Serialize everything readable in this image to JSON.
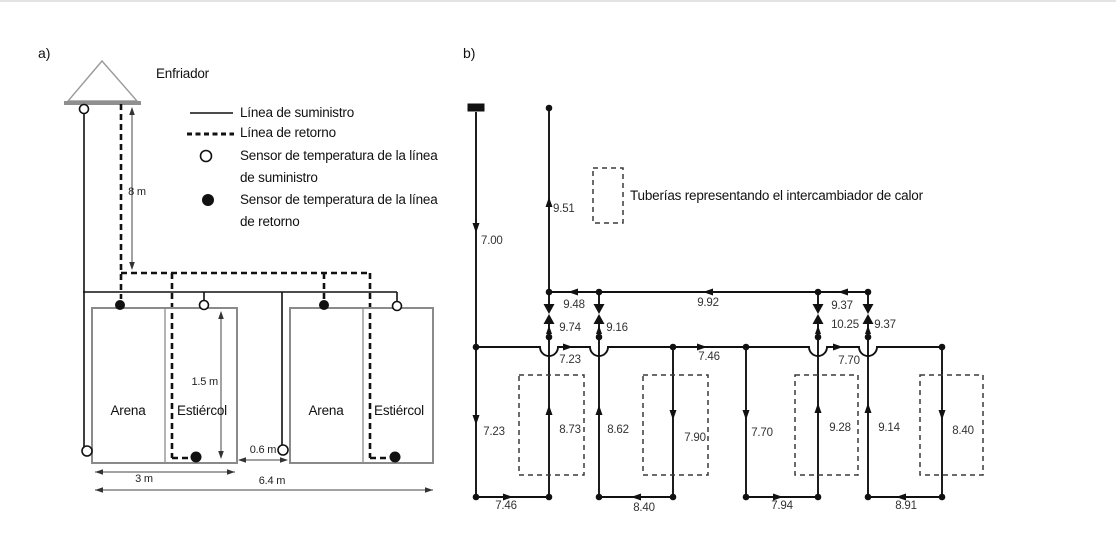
{
  "panel_a": {
    "tag": "a)",
    "cooler_label": "Enfriador",
    "legend": {
      "supply_line": "Línea de suministro",
      "return_line": "Línea de retorno",
      "supply_sensor_l1": "Sensor de temperatura de la línea",
      "supply_sensor_l2": "de suministro",
      "return_sensor_l1": "Sensor de temperatura de la línea",
      "return_sensor_l2": "de retorno"
    },
    "dims": {
      "h8": "8 m",
      "d15": "1.5 m",
      "g06": "0.6 m",
      "w3": "3 m",
      "w64": "6.4 m"
    },
    "tanks": {
      "t1_left": "Arena",
      "t1_right": "Estiércol",
      "t2_left": "Arena",
      "t2_right": "Estiércol"
    }
  },
  "panel_b": {
    "tag": "b)",
    "legend_label": "Tuberías representando el intercambiador de calor",
    "flows": {
      "supply_inlet": "7.00",
      "return_outlet": "9.51",
      "return_seg_left": "9.48",
      "return_seg_mid": "9.92",
      "return_seg_right": "9.37",
      "valve_1": "9.74",
      "valve_2": "9.16",
      "valve_3": "10.25",
      "valve_4": "9.37",
      "supply_seg_1": "7.23",
      "supply_seg_2": "7.46",
      "supply_seg_3": "7.70",
      "col_down_1": "7.23",
      "col_up_1": "8.73",
      "col_up_2": "8.62",
      "col_down_2": "7.90",
      "col_down_3": "7.70",
      "col_up_3": "9.28",
      "col_up_4": "9.14",
      "col_down_4": "8.40",
      "bottom_1": "7.46",
      "bottom_2": "8.40",
      "bottom_3": "7.94",
      "bottom_4": "8.91"
    }
  },
  "colors": {
    "pipe": "#111111",
    "tank_outline": "#8a8a8a",
    "dashed_exchanger": "#3a3a3a"
  }
}
